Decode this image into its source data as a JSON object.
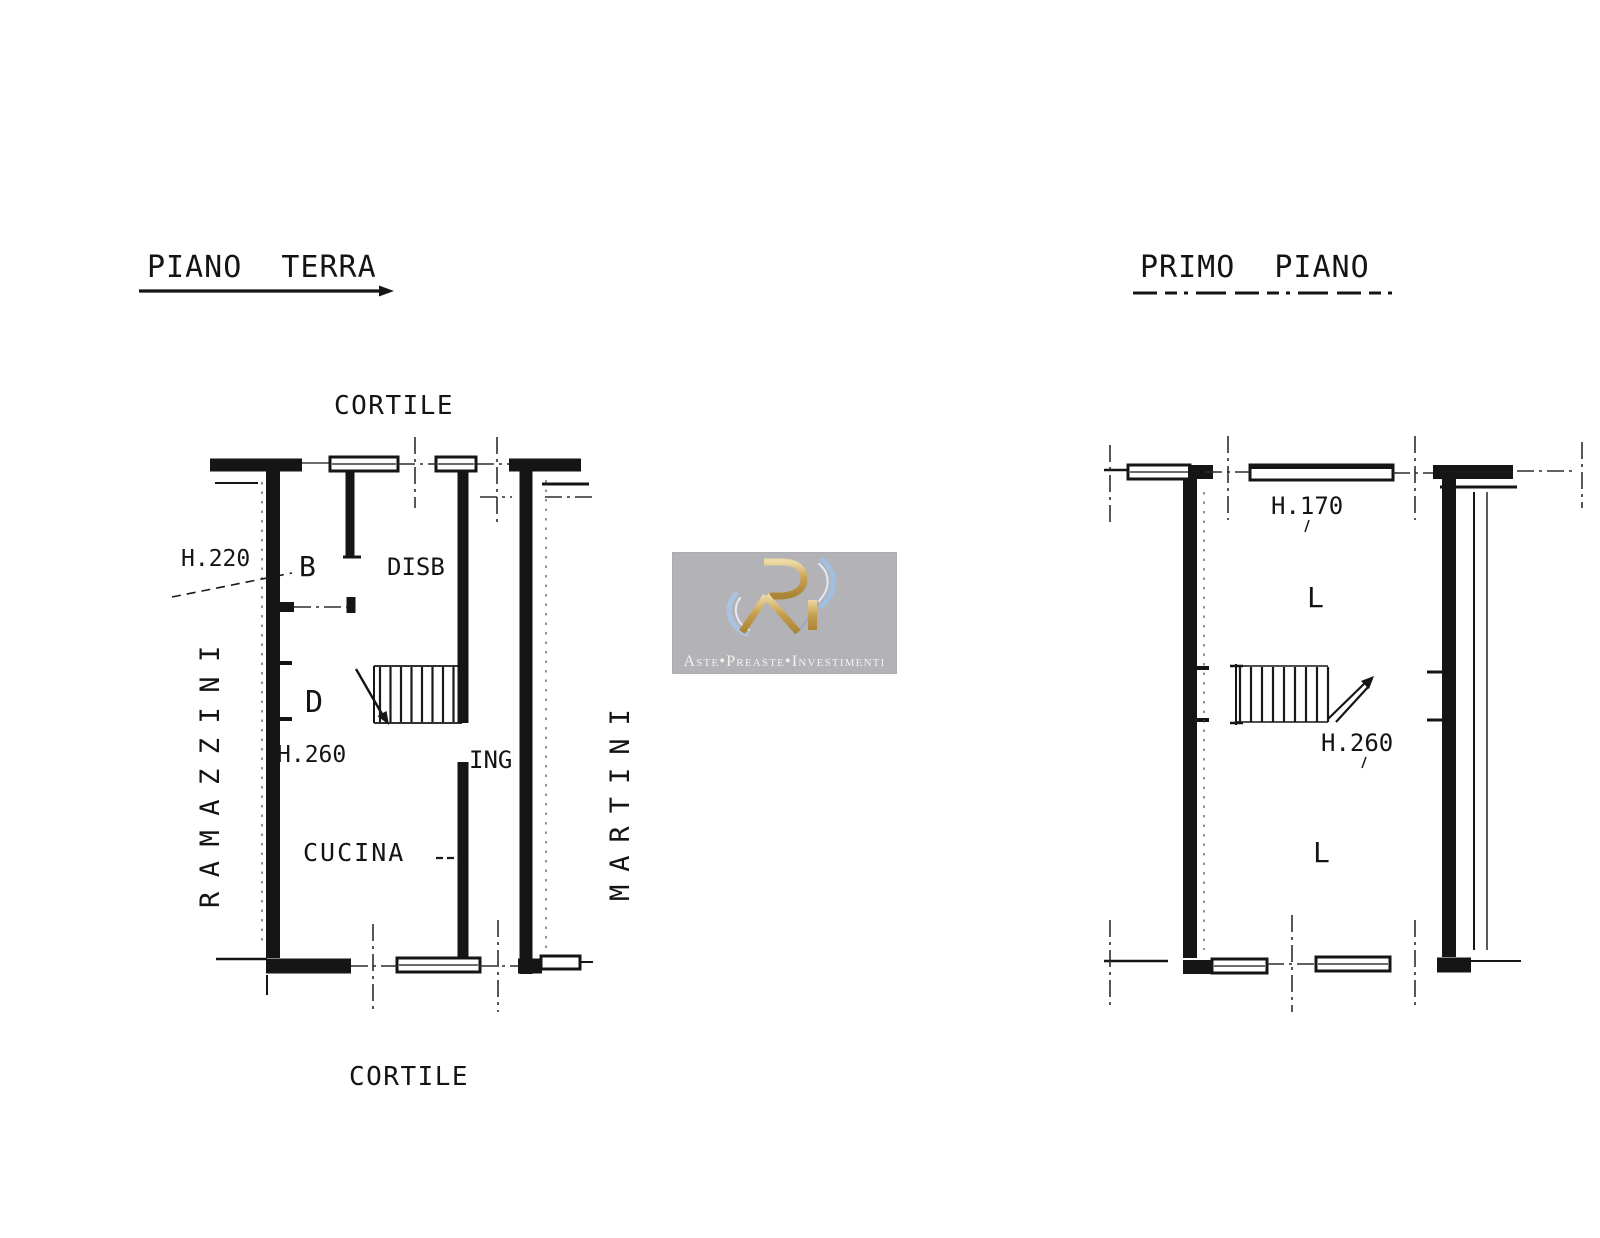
{
  "page": {
    "background": "#ffffff",
    "ink": "#151515"
  },
  "left_plan": {
    "title": "PIANO TERRA",
    "cortile_top": "CORTILE",
    "cortile_bottom": "CORTILE",
    "street_left": "RAMAZZINI",
    "street_right": "MARTINI",
    "dims": {
      "h220": "H.220",
      "h260": "H.260"
    },
    "rooms": {
      "b": "B",
      "disb": "DISB",
      "d": "D",
      "ing": "ING",
      "cucina": "CUCINA"
    }
  },
  "right_plan": {
    "title": "PRIMO PIANO",
    "dims": {
      "h170": "H.170",
      "h260": "H.260"
    },
    "rooms": {
      "l_upper": "L",
      "l_lower": "L"
    }
  },
  "watermark": {
    "logo_icon": "rai-monogram-icon",
    "caption": "Aste•Preaste•Investimenti",
    "colors": {
      "panel": "#b3b3b7",
      "gold": "#c79f4e",
      "blue": "#9fc0e6",
      "text": "#f4f2ee"
    }
  }
}
